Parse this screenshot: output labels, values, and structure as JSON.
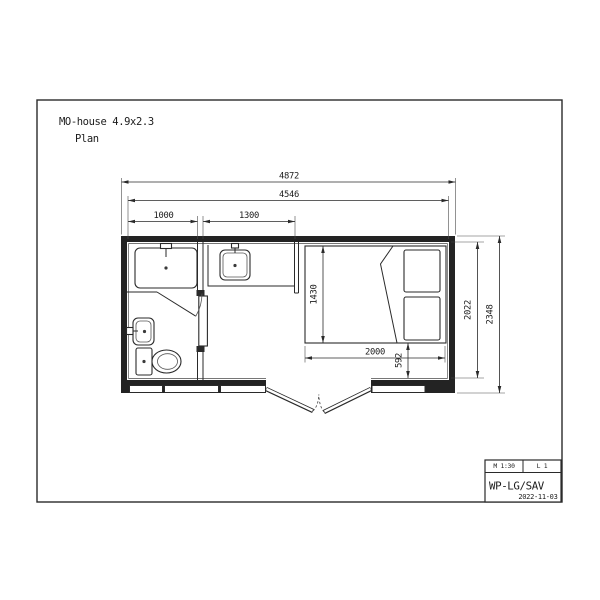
{
  "drawing": {
    "title": "MO-house 4.9x2.3",
    "subtitle": "Plan"
  },
  "dimensions": {
    "overall_width": "4872",
    "inner_width": "4546",
    "bathroom_width": "1000",
    "kitchen_width": "1300",
    "bed_width": "1430",
    "bed_length": "2000",
    "bed_to_wall": "592",
    "inner_depth": "2022",
    "overall_depth": "2348"
  },
  "title_block": {
    "scale": "M 1:30",
    "sheet": "L 1",
    "code": "WP-LG/SAV",
    "date": "2022-11-03"
  }
}
